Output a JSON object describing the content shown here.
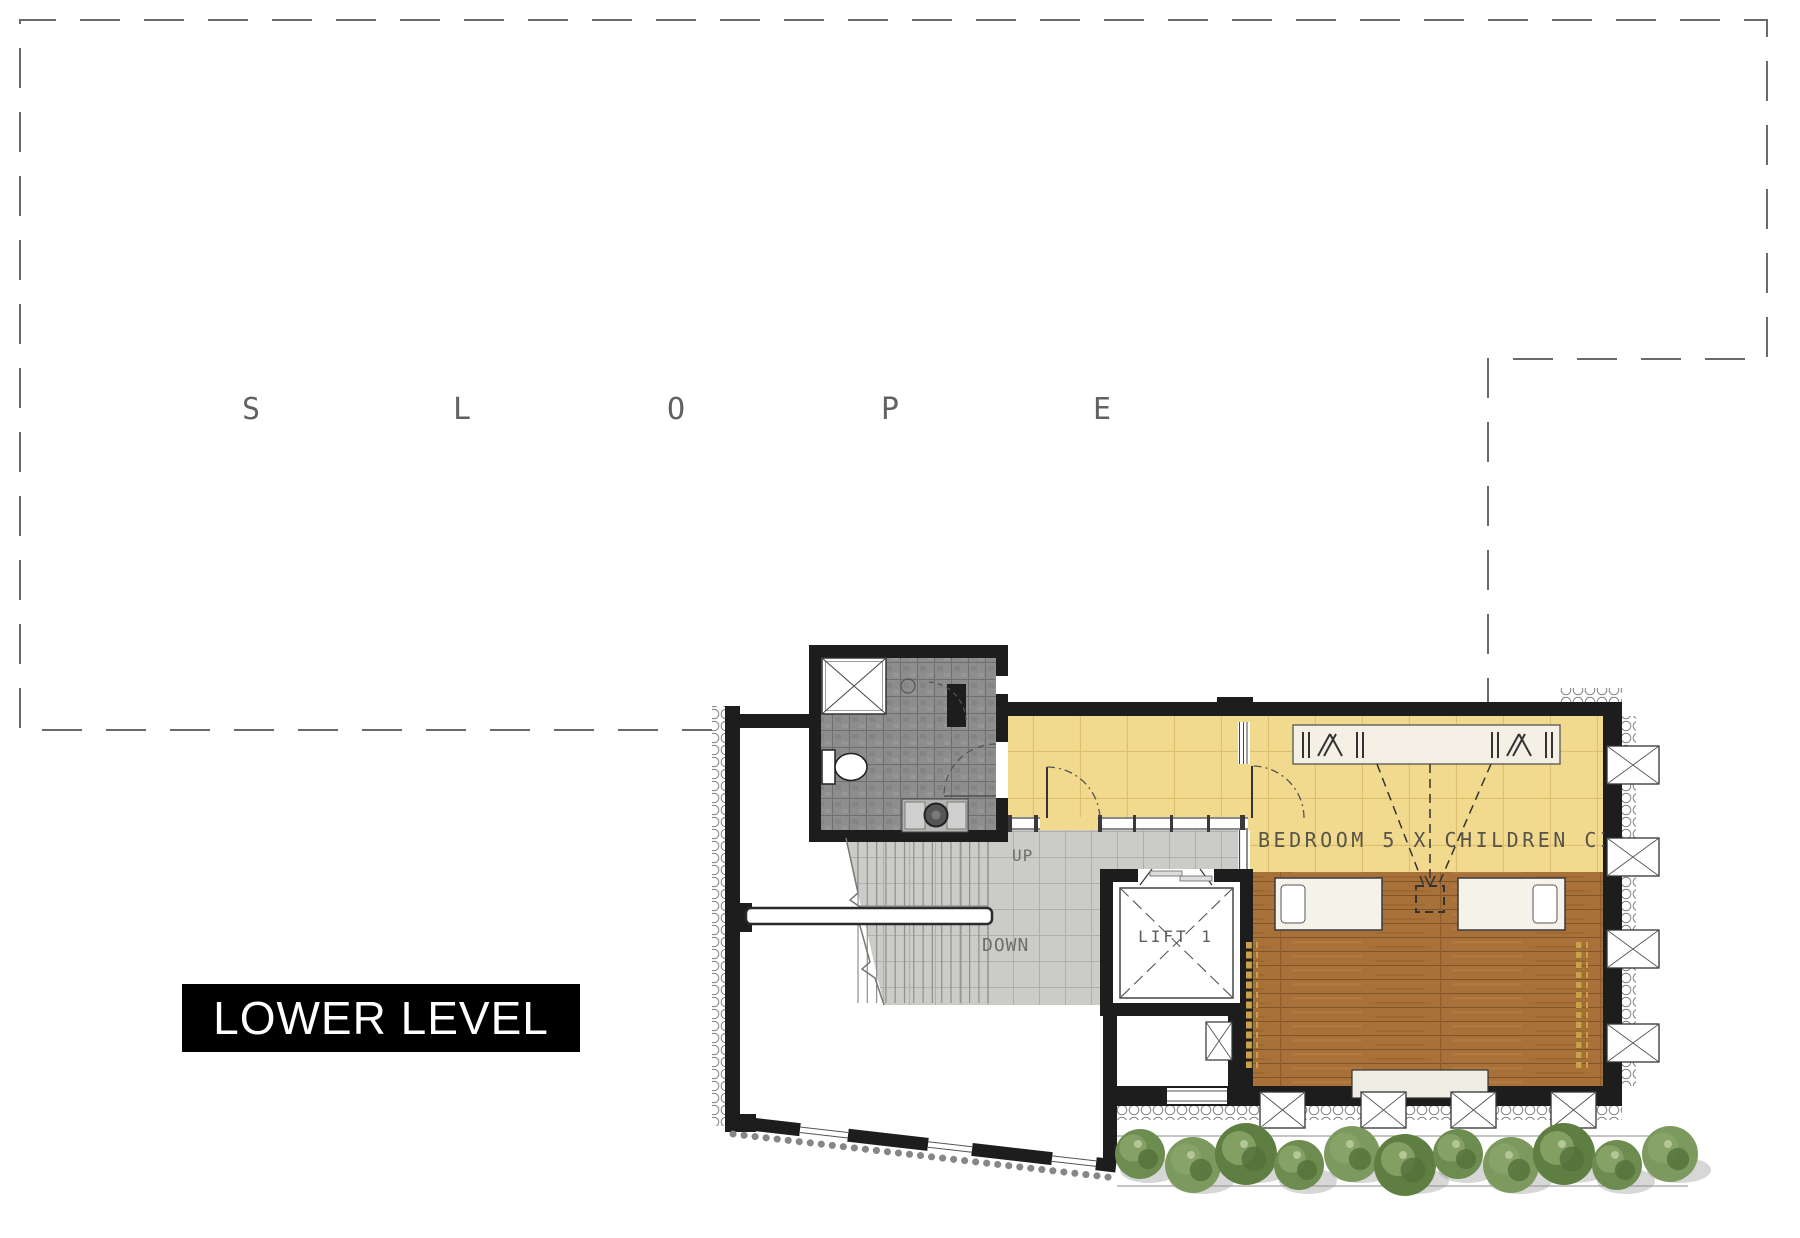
{
  "title": "LOWER LEVEL",
  "slope": {
    "letters": [
      "S",
      "L",
      "O",
      "P",
      "E"
    ]
  },
  "plan": {
    "room_label": "BEDROOM 5 X CHILDREN CINEMA",
    "stairs": {
      "up": "UP",
      "down": "DOWN"
    },
    "lift": {
      "label": "LIFT 1"
    }
  },
  "colors": {
    "floor_yellow": "#f1da8d",
    "floor_wood": "#a9713a",
    "tile_dark": "#8d8d8d",
    "tile_light": "#cbcbc8",
    "wall_black": "#1d1d1d",
    "gold_beads": "#c8a14b",
    "hedge_green": "#6d8c4f",
    "boundary_gray": "#6a6a6a",
    "label_bg": "#000000",
    "label_fg": "#ffffff",
    "plan_text": "#57544a"
  }
}
